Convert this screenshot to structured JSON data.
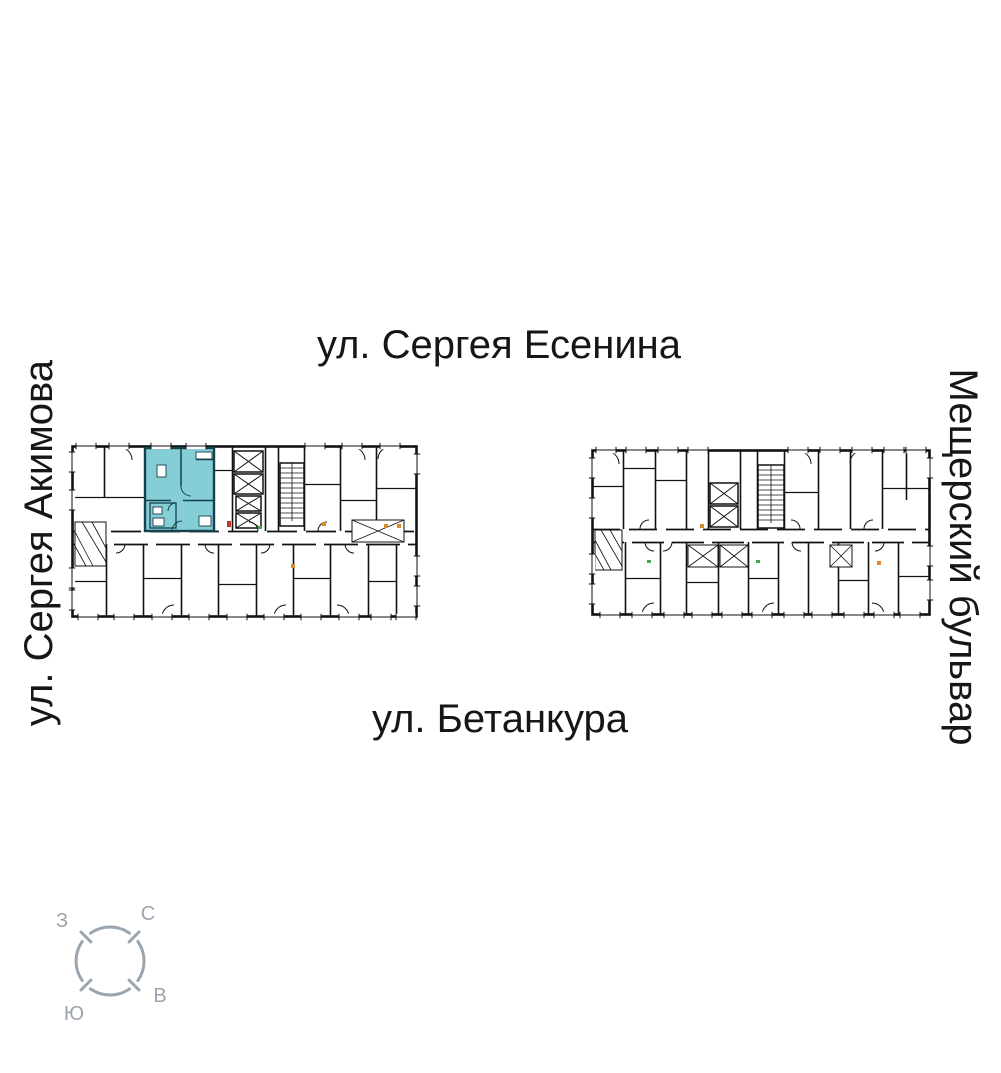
{
  "streets": {
    "top": "ул. Сергея Есенина",
    "bottom": "ул. Бетанкура",
    "left": "ул. Сергея Акимова",
    "right": "Мещерский бульвар"
  },
  "compass": {
    "north": "С",
    "west": "З",
    "east": "В",
    "south": "Ю",
    "color": "#9AA5B0"
  },
  "plan": {
    "background": "#ffffff",
    "wall_color": "#121212",
    "highlight": {
      "fill": "#86CED6",
      "wall_color": "#15404E"
    },
    "accents": {
      "orange": "#D98A2B",
      "green": "#49A24F",
      "red": "#C0392B"
    }
  }
}
